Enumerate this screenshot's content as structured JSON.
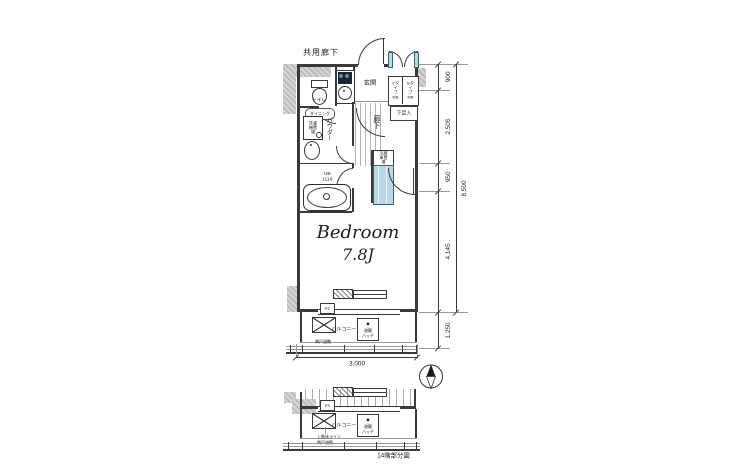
{
  "header": {
    "corridor_label": "共用廊下"
  },
  "unit": {
    "genkan": "玄関",
    "toilet": "トイレ",
    "dining": "ダイニング",
    "hallway": "廊下",
    "powder": "パウダー",
    "laundry": "洗濯機置場",
    "bath_ub": "UB",
    "bath_size": "1116",
    "shoebox": "下足入",
    "mb_c": "Cタイプ MB",
    "mb_b": "Bタイプ MB",
    "fridge": "冷蔵庫置場",
    "ps": "PS",
    "bedroom_name": "Bedroom",
    "bedroom_size": "7.8J"
  },
  "balcony": {
    "label": "バルコニー",
    "hatch_icon": "▲",
    "hatch_l1": "避難",
    "hatch_l2": "ハッチ",
    "neighbor_note": "隣戸避難",
    "upper_floor_note": "上階床ライン"
  },
  "dimensions": {
    "right_segments": [
      "900",
      "2,505",
      "950",
      "4,145"
    ],
    "overall_height": "8,500",
    "balcony_depth": "1,250",
    "width": "3,000"
  },
  "footer": {
    "caption": "14階部分図"
  },
  "colors": {
    "fixture_blue": "#b7d9e6",
    "wall_gray": "#c9c9c9",
    "line": "#3a3a3a"
  }
}
